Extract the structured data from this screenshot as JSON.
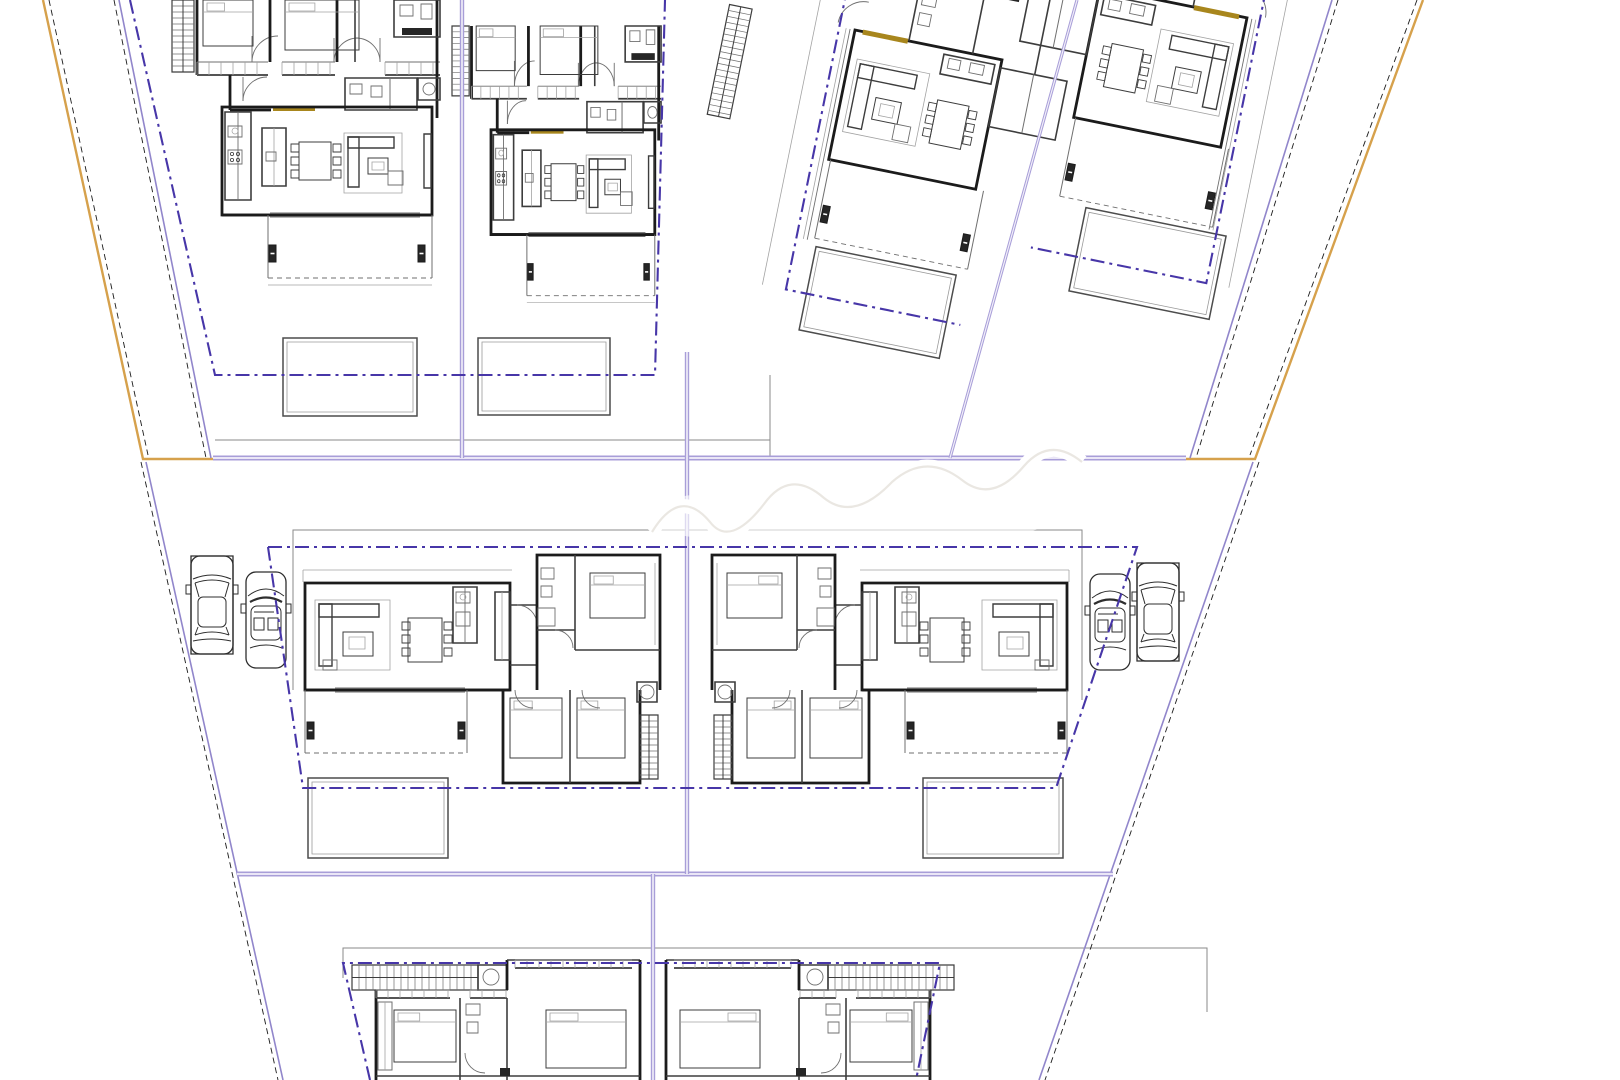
{
  "canvas": {
    "width": 1620,
    "height": 1080,
    "background": "#ffffff"
  },
  "palette": {
    "wall": "#1b1b1b",
    "mid": "#3d3d3d",
    "thin": "#6f6f6f",
    "light": "#a3a3a3",
    "fill_dark": "#262626",
    "purple_thick": "#a89ed8",
    "purple_core": "#f3f1fa",
    "purple_thin": "#9186cb",
    "navy_dashdot": "#4736a8",
    "orange": "#d6a14c",
    "gold": "#a8861d",
    "car_line": "#2e2e2e",
    "pool_line": "#4c4c4c",
    "pool_inner": "#9a9a9a",
    "watermark_ink": "#e8e5df"
  },
  "site": {
    "boundaries": [
      {
        "name": "boundary-left-orange",
        "color": "orange",
        "width": 2.4,
        "points": [
          [
            43,
            0
          ],
          [
            143,
            459
          ],
          [
            213,
            459
          ]
        ]
      },
      {
        "name": "boundary-left-dashed",
        "color": "wall",
        "width": 0.9,
        "dash": "6 4",
        "points": [
          [
            49,
            0
          ],
          [
            148,
            455
          ]
        ]
      },
      {
        "name": "boundary-left-inner-purple",
        "color": "purple_thin",
        "width": 1.6,
        "points": [
          [
            119,
            0
          ],
          [
            211,
            458
          ]
        ]
      },
      {
        "name": "boundary-left-inner-dashed",
        "color": "wall",
        "width": 0.9,
        "dash": "6 4",
        "points": [
          [
            114,
            0
          ],
          [
            206,
            458
          ]
        ]
      },
      {
        "name": "boundary-left-lower-purple",
        "color": "purple_thin",
        "width": 1.6,
        "points": [
          [
            146,
            462
          ],
          [
            283,
            1080
          ]
        ]
      },
      {
        "name": "boundary-left-lower-dashed",
        "color": "wall",
        "width": 0.9,
        "dash": "6 4",
        "points": [
          [
            141,
            462
          ],
          [
            278,
            1080
          ]
        ]
      },
      {
        "name": "boundary-right-orange",
        "color": "orange",
        "width": 2.4,
        "points": [
          [
            1423,
            0
          ],
          [
            1255,
            459
          ],
          [
            1186,
            459
          ]
        ]
      },
      {
        "name": "boundary-right-dashed",
        "color": "wall",
        "width": 0.9,
        "dash": "6 4",
        "points": [
          [
            1417,
            0
          ],
          [
            1250,
            455
          ]
        ]
      },
      {
        "name": "boundary-right-inner-purple",
        "color": "purple_thin",
        "width": 1.6,
        "points": [
          [
            1332,
            0
          ],
          [
            1190,
            458
          ]
        ]
      },
      {
        "name": "boundary-right-inner-dashed",
        "color": "wall",
        "width": 0.9,
        "dash": "6 4",
        "points": [
          [
            1338,
            0
          ],
          [
            1196,
            458
          ]
        ]
      },
      {
        "name": "boundary-right-lower-purple",
        "color": "purple_thin",
        "width": 1.6,
        "points": [
          [
            1253,
            462
          ],
          [
            1039,
            1080
          ]
        ]
      },
      {
        "name": "boundary-right-lower-dashed",
        "color": "wall",
        "width": 0.9,
        "dash": "6 4",
        "points": [
          [
            1259,
            462
          ],
          [
            1045,
            1080
          ]
        ]
      }
    ],
    "dividers": [
      {
        "name": "divider-row-top",
        "width": 5,
        "points": [
          [
            213,
            458
          ],
          [
            1186,
            458
          ]
        ]
      },
      {
        "name": "divider-row-middle",
        "width": 5,
        "points": [
          [
            237,
            874
          ],
          [
            1113,
            874
          ]
        ]
      },
      {
        "name": "divider-plot-a-b",
        "width": 4.4,
        "points": [
          [
            462,
            0
          ],
          [
            462,
            458
          ]
        ]
      },
      {
        "name": "divider-plot-middle",
        "width": 4.4,
        "points": [
          [
            687,
            352
          ],
          [
            687,
            874
          ]
        ]
      },
      {
        "name": "divider-plot-bottom",
        "width": 4.4,
        "points": [
          [
            653,
            874
          ],
          [
            653,
            1080
          ]
        ]
      },
      {
        "name": "divider-plot-c-d",
        "width": 3.2,
        "points": [
          [
            1077,
            0
          ],
          [
            950,
            458
          ]
        ]
      }
    ],
    "setbacks": [
      {
        "name": "setback-plots-a-b",
        "points": [
          [
            130,
            0
          ],
          [
            215,
            375
          ],
          [
            655,
            375
          ],
          [
            665,
            0
          ]
        ]
      },
      {
        "name": "setback-plot-middle",
        "points": [
          [
            268,
            547
          ],
          [
            1137,
            547
          ],
          [
            1056,
            788
          ],
          [
            303,
            788
          ],
          [
            268,
            547
          ]
        ]
      },
      {
        "name": "setback-plot-bottom",
        "points": [
          [
            370,
            1080
          ],
          [
            343,
            963
          ],
          [
            940,
            963
          ],
          [
            916,
            1080
          ]
        ]
      }
    ],
    "thin_lines": [
      {
        "name": "plot-line-top-yards",
        "points": [
          [
            215,
            440
          ],
          [
            770,
            440
          ]
        ]
      },
      {
        "name": "plot-line-top-gap",
        "points": [
          [
            770,
            375
          ],
          [
            770,
            458
          ]
        ]
      },
      {
        "name": "plot-line-middle-top",
        "points": [
          [
            293,
            690
          ],
          [
            293,
            530
          ],
          [
            1082,
            530
          ],
          [
            1082,
            700
          ]
        ]
      },
      {
        "name": "plot-line-bottom-top",
        "points": [
          [
            343,
            978
          ],
          [
            343,
            948
          ],
          [
            1207,
            948
          ],
          [
            1207,
            1012
          ]
        ]
      }
    ]
  },
  "units": [
    {
      "id": "villa-a",
      "type": "villa-top",
      "transform": "translate(172,0)"
    },
    {
      "id": "villa-b",
      "type": "villa-top",
      "transform": "translate(452,26) scale(0.78,0.97)"
    },
    {
      "id": "villa-c",
      "type": "villa-rotated",
      "variant": "sofa-left",
      "stairs": true,
      "transform": "translate(855,30) rotate(11.5)",
      "pool_offset": [
        5,
        220
      ]
    },
    {
      "id": "villa-d",
      "type": "villa-rotated",
      "variant": "sofa-right",
      "stairs": false,
      "transform": "translate(1100,-12) rotate(11.5)",
      "pool_offset": [
        30,
        218
      ]
    },
    {
      "id": "house-middle-left",
      "type": "villa-middle",
      "transform": "translate(305,570)"
    },
    {
      "id": "house-middle-right",
      "type": "villa-middle",
      "transform": "translate(1067,570) scale(-1,1)"
    },
    {
      "id": "house-bottom-left",
      "type": "villa-bottom",
      "transform": "translate(350,958)"
    },
    {
      "id": "house-bottom-right",
      "type": "villa-bottom",
      "transform": "translate(956,958) scale(-1,1)"
    }
  ],
  "pools": [
    {
      "id": "pool-villa-a",
      "x": 283,
      "y": 338,
      "w": 134,
      "h": 78
    },
    {
      "id": "pool-villa-b",
      "x": 478,
      "y": 338,
      "w": 132,
      "h": 77
    },
    {
      "id": "pool-house-middle-left",
      "x": 308,
      "y": 778,
      "w": 140,
      "h": 80
    },
    {
      "id": "pool-house-middle-right",
      "x": 923,
      "y": 778,
      "w": 140,
      "h": 80
    }
  ],
  "cars": [
    {
      "id": "car-1",
      "variant": "sedan",
      "cx": 212,
      "cy": 605
    },
    {
      "id": "car-2",
      "variant": "open",
      "cx": 266,
      "cy": 620
    },
    {
      "id": "car-3",
      "variant": "open",
      "cx": 1110,
      "cy": 622
    },
    {
      "id": "car-4",
      "variant": "sedan",
      "cx": 1158,
      "cy": 612
    }
  ],
  "watermark": {
    "present": true,
    "cx": 845,
    "cy": 516
  }
}
